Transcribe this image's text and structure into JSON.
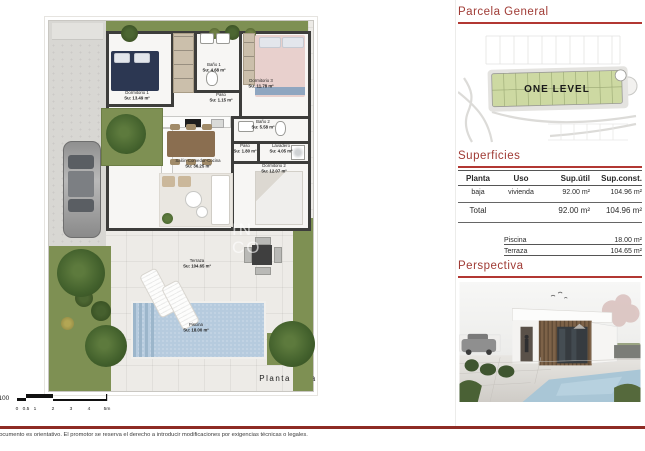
{
  "headings": {
    "parcela": "Parcela General",
    "superficies": "Superficies",
    "perspectiva": "Perspectiva"
  },
  "parcela": {
    "plot_label": "ONE LEVEL"
  },
  "superficies": {
    "headers": [
      "Planta",
      "Uso",
      "Sup.útil",
      "Sup.const."
    ],
    "row": {
      "planta": "baja",
      "uso": "vivienda",
      "util": "92.00 m²",
      "const": "104.96 m²"
    },
    "total": {
      "label": "Total",
      "util": "92.00 m²",
      "const": "104.96 m²"
    },
    "extras": [
      {
        "label": "Piscina",
        "value": "18.00 m²"
      },
      {
        "label": "Terraza",
        "value": "104.65 m²"
      }
    ]
  },
  "floorplan": {
    "caption": "Planta Baja",
    "watermark": [
      "IN",
      "CO"
    ],
    "rooms": {
      "dormitorio1": {
        "name": "Dormitorio 1",
        "area": "Su: 13.49 m²"
      },
      "bano1": {
        "name": "Baño 1",
        "area": "Su: 4.68 m²"
      },
      "dormitorio3": {
        "name": "Dormitorio 3",
        "area": "Su: 11.78 m²"
      },
      "paso1": {
        "name": "Paso",
        "area": "Su: 1.15 m²"
      },
      "bano2": {
        "name": "Baño 2",
        "area": "Su: 5.58 m²"
      },
      "paso2": {
        "name": "Paso",
        "area": "Su: 1.80 m²"
      },
      "lavadero": {
        "name": "Lavadero",
        "area": "Su: 4.05 m²"
      },
      "salon": {
        "name": "Salón-Comedor-Cocina",
        "area": "Su: 36.25 m²"
      },
      "dormitorio2": {
        "name": "Dormitorio 2",
        "area": "Su: 12.07 m²"
      },
      "terraza": {
        "name": "Terraza",
        "area": "Su: 104.65 m²"
      },
      "piscina": {
        "name": "Piscina",
        "area": "Su: 18.00 m²"
      }
    }
  },
  "scalebar": {
    "ratio": "1/100",
    "ticks": [
      "0",
      "0.5",
      "1",
      "2",
      "3",
      "4",
      "5m"
    ]
  },
  "footer": {
    "disclaimer": "documento es orientativo. El promotor se reserva el derecho a introducir modificaciones por exigencias técnicas o legales."
  },
  "colors": {
    "accent_red": "#b23732",
    "heading_red": "#a03b35",
    "footer_band": "#8e2b24",
    "plot_green": "#cdd9a2",
    "grass_green": "#7e9053",
    "pool_blue": "#b6cbde"
  }
}
